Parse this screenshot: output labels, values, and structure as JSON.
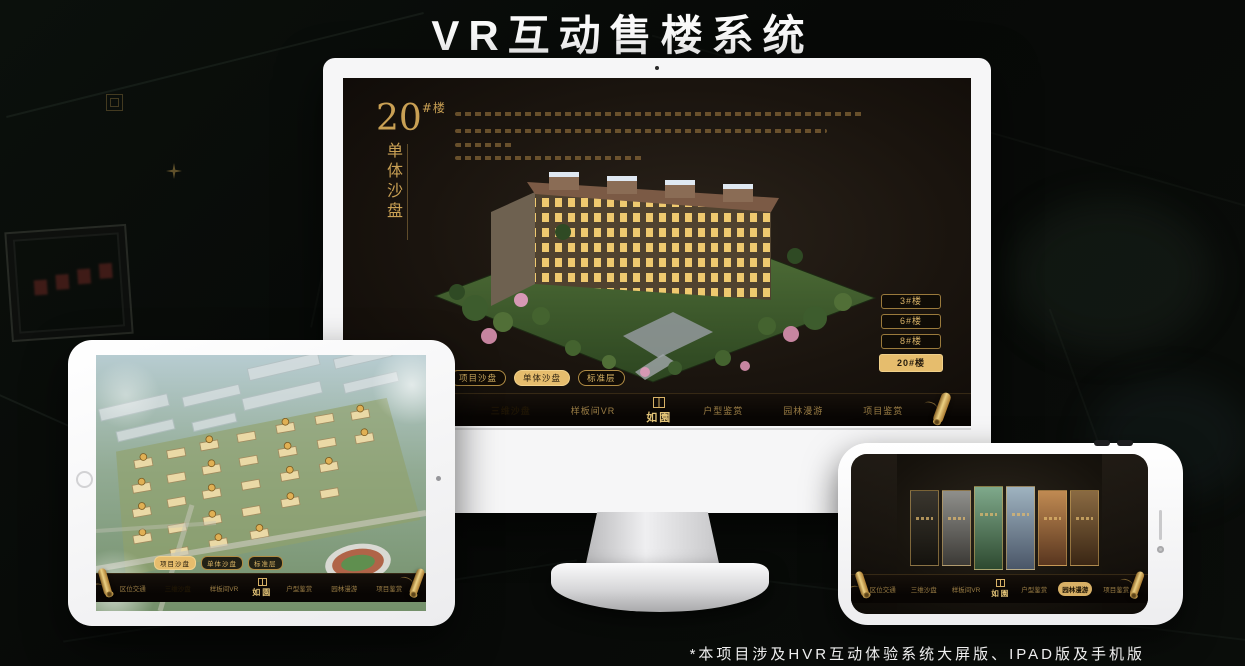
{
  "title": "VR互动售楼系统",
  "footnote": "*本项目涉及HVR互动体验系统大屏版、IPAD版及手机版",
  "colors": {
    "gold": "#c9a054",
    "gold_selected_bg": "#e6bd6d",
    "selected_text": "#241a0c",
    "screen_bg": "#171210",
    "title_text": "#fafafa"
  },
  "logo": {
    "text": "如園",
    "seal_icon": "seal-icon"
  },
  "monitor": {
    "headline": {
      "number": "20",
      "suffix": "#楼",
      "subtitle": "单体沙盘"
    },
    "building_buttons": [
      {
        "label": "3#楼",
        "selected": false
      },
      {
        "label": "6#楼",
        "selected": false
      },
      {
        "label": "8#楼",
        "selected": false
      },
      {
        "label": "20#楼",
        "selected": true
      }
    ],
    "sub_tabs": [
      {
        "label": "项目沙盘",
        "selected": false
      },
      {
        "label": "单体沙盘",
        "selected": true
      },
      {
        "label": "标准层",
        "selected": false
      }
    ],
    "nav_left": [
      {
        "label": "区位交通",
        "selected": false
      },
      {
        "label": "三维沙盘",
        "selected": true
      },
      {
        "label": "样板间VR",
        "selected": false
      }
    ],
    "nav_right": [
      {
        "label": "户型鉴赏",
        "selected": false
      },
      {
        "label": "园林漫游",
        "selected": false
      },
      {
        "label": "项目鉴赏",
        "selected": false
      }
    ]
  },
  "tablet": {
    "sub_tabs": [
      {
        "label": "项目沙盘",
        "selected": true
      },
      {
        "label": "单体沙盘",
        "selected": false
      },
      {
        "label": "标准层",
        "selected": false
      }
    ],
    "nav_left": [
      {
        "label": "区位交通",
        "selected": false
      },
      {
        "label": "三维沙盘",
        "selected": true
      },
      {
        "label": "样板间VR",
        "selected": false
      }
    ],
    "nav_right": [
      {
        "label": "户型鉴赏",
        "selected": false
      },
      {
        "label": "园林漫游",
        "selected": false
      },
      {
        "label": "项目鉴赏",
        "selected": false
      }
    ]
  },
  "phone": {
    "nav_left": [
      {
        "label": "区位交通",
        "selected": false
      },
      {
        "label": "三维沙盘",
        "selected": false
      },
      {
        "label": "样板间VR",
        "selected": false
      }
    ],
    "nav_right": [
      {
        "label": "户型鉴赏",
        "selected": false
      },
      {
        "label": "园林漫游",
        "selected": true
      },
      {
        "label": "项目鉴赏",
        "selected": false
      }
    ]
  }
}
